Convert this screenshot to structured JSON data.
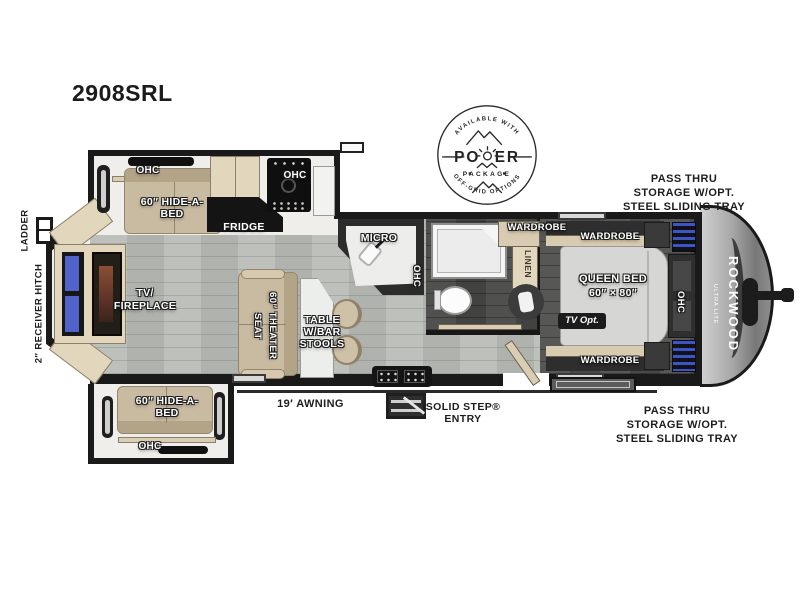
{
  "header": {
    "model": "2908SRL"
  },
  "badge": {
    "available": "AVAILABLE WITH",
    "power_left": "PO",
    "power_right": "ER",
    "package": "PACKAGE",
    "offgrid": "OFF-GRID OPTIONS"
  },
  "exterior": {
    "ladder": "LADDER",
    "hitch": "2″ RECEIVER HITCH",
    "awning": "19′ AWNING",
    "entry": [
      "SOLID STEP®",
      "ENTRY"
    ],
    "pass_thru_top": [
      "PASS THRU",
      "STORAGE W/OPT.",
      "STEEL SLIDING TRAY"
    ],
    "pass_thru_bottom": [
      "PASS THRU",
      "STORAGE W/OPT.",
      "STEEL SLIDING TRAY"
    ],
    "brand": "ROCKWOOD",
    "brand_sub": "ULTRA LITE"
  },
  "living": {
    "ohc_top": "OHC",
    "hide_a_bed_top": [
      "60″ HIDE-A-",
      "BED"
    ],
    "fridge": "FRIDGE",
    "ohc_range": "OHC",
    "tv_fireplace": [
      "TV/",
      "FIREPLACE"
    ],
    "theater_seat": "60″ THEATER SEAT",
    "table": [
      "TABLE",
      "W/BAR",
      "STOOLS"
    ],
    "hide_a_bed_bottom": [
      "60″ HIDE-A-",
      "BED"
    ],
    "ohc_bottom": "OHC"
  },
  "kitchen": {
    "micro": "MICRO",
    "ohc": "OHC"
  },
  "bath": {
    "linen": "LINEN"
  },
  "bedroom": {
    "wardrobe_corner": "WARDROBE",
    "wardrobe_top": "WARDROBE",
    "wardrobe_bottom": "WARDROBE",
    "bed": [
      "QUEEN BED",
      "60″ × 80″"
    ],
    "tv_opt": "TV Opt.",
    "ohc": "OHC"
  },
  "colors": {
    "wall": "#1a1a1a",
    "floor": "#b8bbb6",
    "floor_dark": "#4e4f4c",
    "wood": "#e2d6bc",
    "sofa": "#c9bba2",
    "counter_dark": "#141414",
    "tv_blue": "#4f63c8",
    "bed": "#d6d6d4",
    "bin_blue": "#3d55c4"
  }
}
